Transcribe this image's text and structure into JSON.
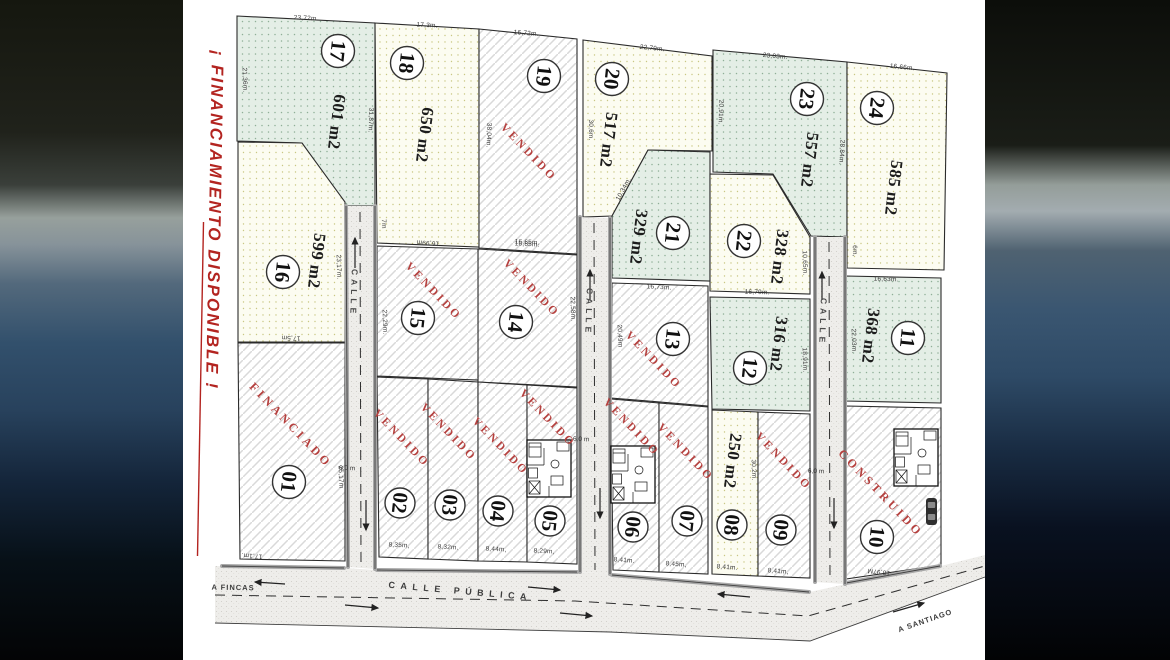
{
  "plan_title_banner": "¡ FINANCIAMIENTO DISPONIBLE !",
  "streets": {
    "calle": "CALLE",
    "width": "6,0 m",
    "public": "CALLE PÚBLICA",
    "to_fincas": "A FINCAS",
    "to_santiago": "A SANTIAGO"
  },
  "colors": {
    "status_red": "#b5413f",
    "banner_red": "#b32420",
    "parcel_green": "#e4eee6",
    "parcel_yellow": "#fcfcf1",
    "road_gray": "#eeedea"
  },
  "lots": {
    "l01": {
      "num": "01",
      "status": "FINANCIADO",
      "m_right": "25,17m",
      "m_bottom": "17,1m."
    },
    "l02": {
      "num": "02",
      "status": "VENDIDO",
      "m_bottom": "8,35m,"
    },
    "l03": {
      "num": "03",
      "status": "VENDIDO",
      "m_bottom": "8,32m."
    },
    "l04": {
      "num": "04",
      "status": "VENDIDO",
      "m_bottom": "8,44m,"
    },
    "l05": {
      "num": "05",
      "status": "VENDIDO",
      "m_bottom": "8,29m,"
    },
    "l06": {
      "num": "06",
      "status": "VENDIDO",
      "m_bottom": "8,41m."
    },
    "l07": {
      "num": "07",
      "status": "VENDIDO",
      "m_bottom": "8,45m,"
    },
    "l08": {
      "num": "08",
      "area": "250 m2",
      "m_right": "30,2m.",
      "m_bottom": "8,41m."
    },
    "l09": {
      "num": "09",
      "status": "VENDIDO",
      "m_bottom": "8,41m,"
    },
    "l10": {
      "num": "10",
      "status": "CONSTRUIDO",
      "m_bottom": "16,97M"
    },
    "l11": {
      "num": "11",
      "area": "368 m2",
      "m_top": "16,63m.",
      "m_left": "22,03m."
    },
    "l12": {
      "num": "12",
      "area": "316 m2",
      "m_right": "18,91m."
    },
    "l13": {
      "num": "13",
      "status": "VENDIDO",
      "m_left": "20,49m"
    },
    "l14": {
      "num": "14",
      "status": "VENDIDO",
      "m_top": "16,65m.",
      "m_right": "22,58m."
    },
    "l15": {
      "num": "15",
      "status": "VENDIDO",
      "m_left": "22,29m."
    },
    "l16": {
      "num": "16",
      "area": "599 m2",
      "m_right": "23,17m.",
      "m_bottom": "17,5m"
    },
    "l17": {
      "num": "17",
      "area": "601 m2",
      "m_top": "23,72m.",
      "m_left": "21,36m.",
      "m_right": "31,87m."
    },
    "l18": {
      "num": "18",
      "area": "650 m2",
      "m_top": "17,3m.",
      "m_bottom": "16,99m",
      "m_side": "7m"
    },
    "l19": {
      "num": "19",
      "status": "VENDIDO",
      "m_top": "16,72m.",
      "m_left": "38,04m.",
      "m_bottom": "16,65m."
    },
    "l20": {
      "num": "20",
      "area": "517 m2",
      "m_top": "22,79m.",
      "m_left": "30,6m."
    },
    "l21": {
      "num": "21",
      "area": "329 m2",
      "m_diag": "10,34m.",
      "m_bottom": "16,73m."
    },
    "l22": {
      "num": "22",
      "area": "328 m2",
      "m_right": "10,65m.",
      "m_bottom": "16,79m."
    },
    "l23": {
      "num": "23",
      "area": "557 m2",
      "m_top": "23,03m.",
      "m_left": "20,91m.",
      "m_right": "28,84m."
    },
    "l24": {
      "num": "24",
      "area": "585 m2",
      "m_top": "16,66m.",
      "m_left": "6m,",
      "m_bottom": "16,63m."
    }
  }
}
